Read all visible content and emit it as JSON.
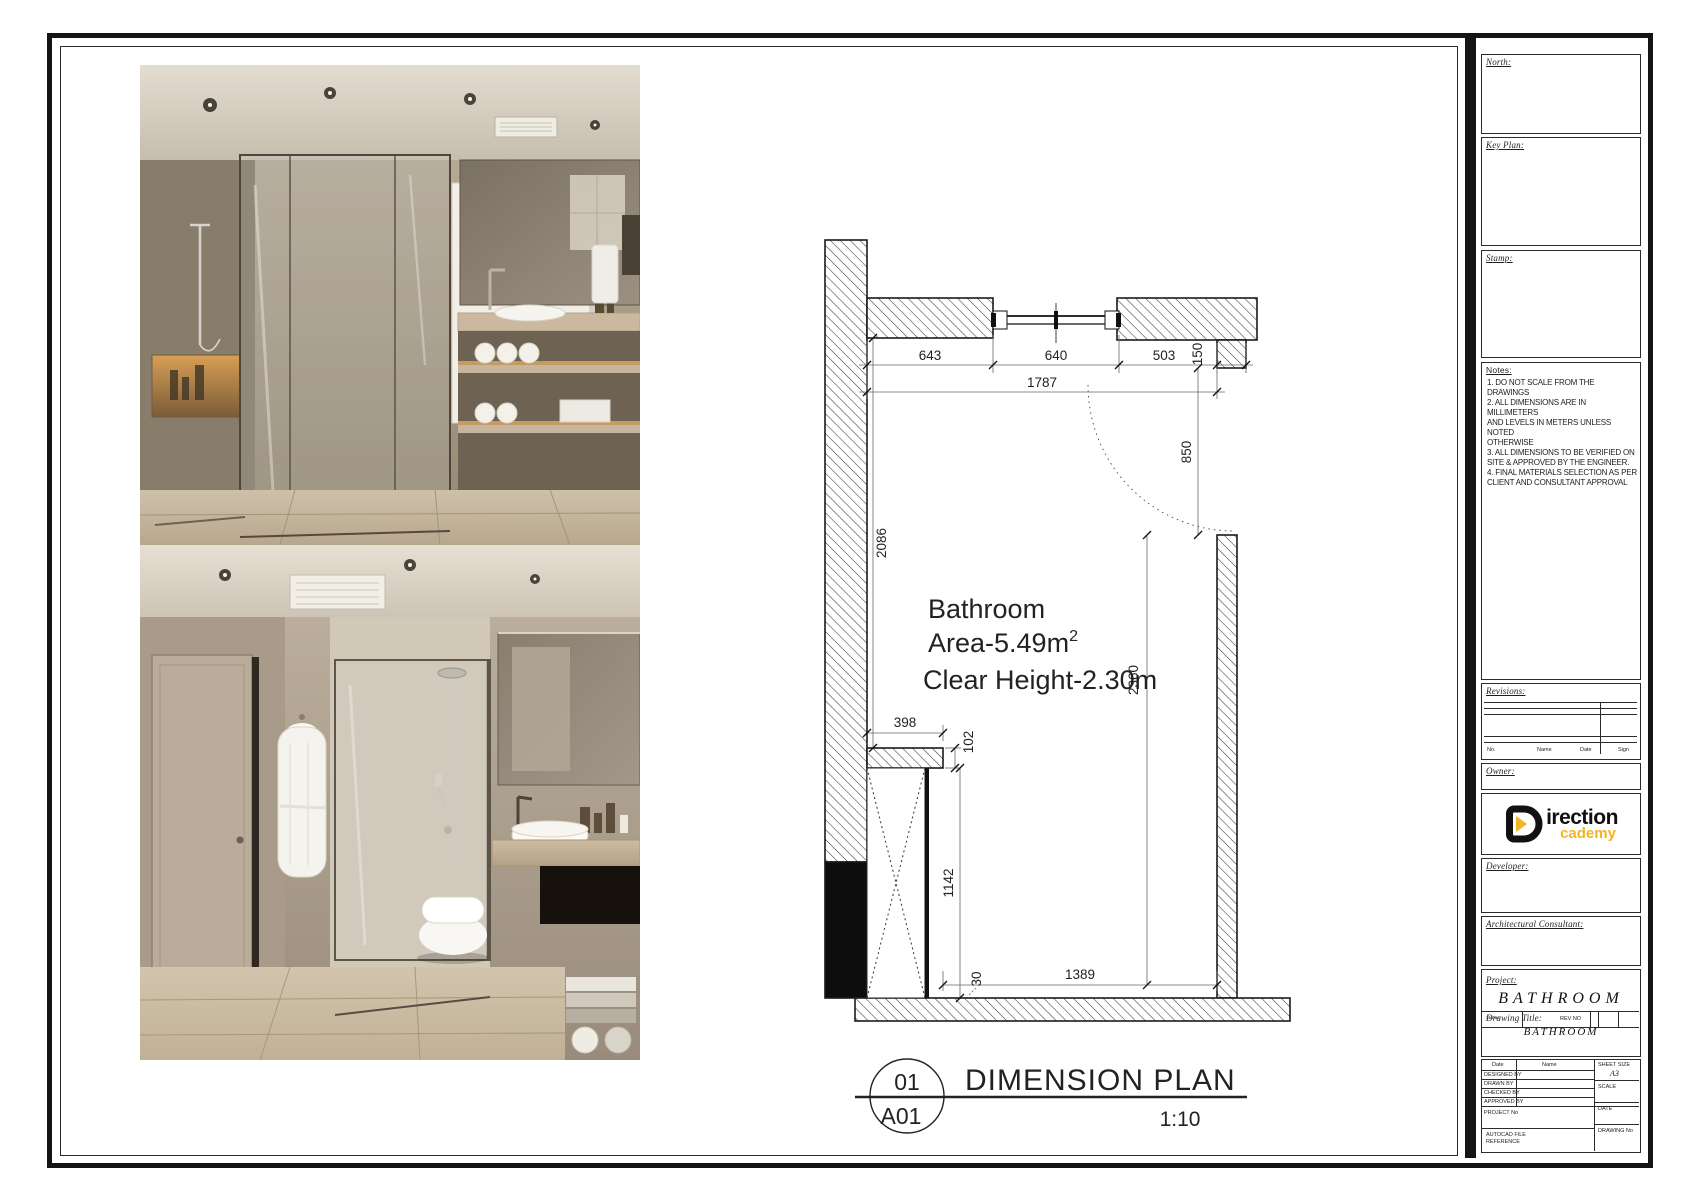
{
  "photos": {
    "top_alt": "Bathroom render: glass shower, wall cabinet, wall-hung toilet, vanity with shelves",
    "bottom_alt": "Bathroom render: door with bathrobe, walk-in shower, floating toilet, stone vanity"
  },
  "plan": {
    "room": {
      "name": "Bathroom",
      "area": "Area-5.49m",
      "area_sup": "2",
      "clear_height": "Clear Height-2.30m"
    },
    "dims": {
      "d643": "643",
      "d640": "640",
      "d503": "503",
      "d150": "150",
      "d1787": "1787",
      "d850": "850",
      "d2086": "2086",
      "d398": "398",
      "d102": "102",
      "d1142": "1142",
      "d2360": "2360",
      "d30": "30",
      "d1389": "1389"
    }
  },
  "callout": {
    "detail_no": "01",
    "sheet_no": "A01",
    "title": "DIMENSION PLAN",
    "scale": "1:10"
  },
  "titleblock": {
    "north_label": "North:",
    "keyplan_label": "Key Plan:",
    "stamp_label": "Stamp:",
    "notes": {
      "label": "Notes:",
      "lines": [
        "1. DO NOT SCALE FROM THE DRAWINGS",
        "2. ALL DIMENSIONS ARE IN MILLIMETERS",
        "AND LEVELS IN METERS UNLESS NOTED",
        "OTHERWISE",
        "3. ALL DIMENSIONS TO BE VERIFIED ON",
        "SITE & APPROVED BY THE ENGINEER.",
        "4. FINAL MATERIALS SELECTION AS PER",
        "CLIENT AND CONSULTANT APPROVAL"
      ]
    },
    "revisions": {
      "label": "Revisions:",
      "columns": [
        "No.",
        "Name",
        "Date",
        "Sign"
      ]
    },
    "owner_label": "Owner:",
    "logo": {
      "text_black": "irection",
      "text_yellow": "cademy",
      "accent": "#F1B521"
    },
    "developer_label": "Developer:",
    "architect_label": "Architectural Consultant:",
    "project": {
      "label": "Project:",
      "value": "BATHROOM"
    },
    "status": {
      "label": "Status:",
      "rev": "REV NO"
    },
    "drawing_title": {
      "label": "Drawing Title:",
      "value": "BATHROOM"
    },
    "info_table": {
      "date_col": "Date",
      "name_col": "Name",
      "sheet_size_label": "SHEET SIZE",
      "sheet_size_value": "A3",
      "rows": [
        "DESIGNED BY",
        "DRAWN BY",
        "CHECKED BY",
        "APPROVED BY"
      ],
      "scale_label": "SCALE",
      "project_no_label": "PROJECT No",
      "date_label": "DATE",
      "file_label_1": "AUTOCAD FILE",
      "file_label_2": "REFERENCE",
      "drawing_no_label": "DRAWING No"
    }
  }
}
